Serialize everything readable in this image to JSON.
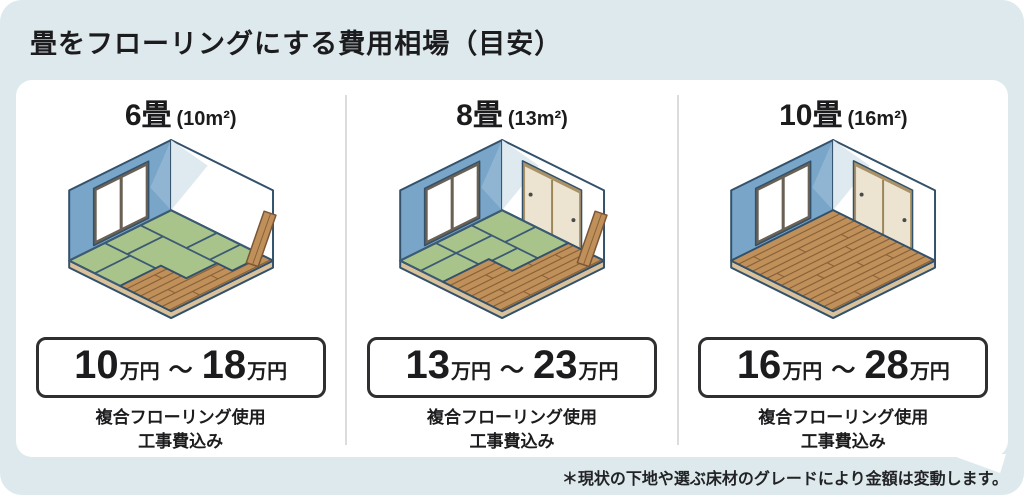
{
  "title": "畳をフローリングにする費用相場（目安）",
  "footnote": "＊現状の下地や選ぶ床材のグレードにより金額は変動します。",
  "panels": [
    {
      "size": "6畳",
      "area": "(10m²)",
      "price_min": "10",
      "price_max": "18",
      "price_unit": "万円",
      "tilde": "～",
      "note_line1": "複合フローリング使用",
      "note_line2": "工事費込み",
      "room": {
        "tatami": true,
        "doors": false,
        "plank": true,
        "wood_polygon": [
          [
            0.5,
            1
          ],
          [
            0.5,
            0.6
          ],
          [
            0.75,
            0.6
          ],
          [
            0.75,
            0.3
          ],
          [
            0.9,
            0.3
          ],
          [
            0.9,
            0
          ],
          [
            1,
            0
          ],
          [
            1,
            1
          ]
        ],
        "tatami_polygon": [
          [
            0,
            0
          ],
          [
            0.9,
            0
          ],
          [
            0.9,
            0.3
          ],
          [
            0.75,
            0.3
          ],
          [
            0.75,
            0.6
          ],
          [
            0.5,
            0.6
          ],
          [
            0.5,
            1
          ],
          [
            0,
            1
          ]
        ],
        "tatami_seams": [
          [
            [
              0,
              0.3
            ],
            [
              0.9,
              0.3
            ]
          ],
          [
            [
              0,
              0.65
            ],
            [
              0.5,
              0.65
            ]
          ],
          [
            [
              0.45,
              0
            ],
            [
              0.45,
              0.3
            ]
          ],
          [
            [
              0.68,
              0
            ],
            [
              0.68,
              0.3
            ]
          ],
          [
            [
              0.22,
              0.3
            ],
            [
              0.22,
              0.65
            ]
          ],
          [
            [
              0.25,
              0.65
            ],
            [
              0.25,
              1
            ]
          ]
        ]
      }
    },
    {
      "size": "8畳",
      "area": "(13m²)",
      "price_min": "13",
      "price_max": "23",
      "price_unit": "万円",
      "tilde": "～",
      "note_line1": "複合フローリング使用",
      "note_line2": "工事費込み",
      "room": {
        "tatami": true,
        "doors": true,
        "plank": true,
        "wood_polygon": [
          [
            0.42,
            1
          ],
          [
            0.42,
            0.55
          ],
          [
            0.65,
            0.55
          ],
          [
            0.65,
            0
          ],
          [
            1,
            0
          ],
          [
            1,
            1
          ]
        ],
        "tatami_polygon": [
          [
            0,
            0
          ],
          [
            0.65,
            0
          ],
          [
            0.65,
            0.55
          ],
          [
            0.42,
            0.55
          ],
          [
            0.42,
            1
          ],
          [
            0,
            1
          ]
        ],
        "tatami_seams": [
          [
            [
              0,
              0.3
            ],
            [
              0.65,
              0.3
            ]
          ],
          [
            [
              0,
              0.65
            ],
            [
              0.42,
              0.65
            ]
          ],
          [
            [
              0.33,
              0
            ],
            [
              0.33,
              0.3
            ]
          ],
          [
            [
              0.45,
              0.3
            ],
            [
              0.45,
              0.55
            ]
          ],
          [
            [
              0.2,
              0.3
            ],
            [
              0.2,
              0.65
            ]
          ],
          [
            [
              0.2,
              0.65
            ],
            [
              0.2,
              1
            ]
          ]
        ]
      }
    },
    {
      "size": "10畳",
      "area": "(16m²)",
      "price_min": "16",
      "price_max": "28",
      "price_unit": "万円",
      "tilde": "～",
      "note_line1": "複合フローリング使用",
      "note_line2": "工事費込み",
      "room": {
        "tatami": false,
        "doors": true,
        "plank": false,
        "wood_polygon": [
          [
            0,
            0
          ],
          [
            1,
            0
          ],
          [
            1,
            1
          ],
          [
            0,
            1
          ]
        ],
        "tatami_polygon": null,
        "tatami_seams": []
      }
    }
  ],
  "colors": {
    "background": "#dde9ec",
    "card": "#ffffff",
    "divider": "#dcdcdc",
    "text": "#1c1c1e",
    "price_border": "#2f2f31",
    "outline": "#33516b",
    "wall_blue": "#78a5c8",
    "wall_white": "#ffffff",
    "wall_shade": "#dfeaf0",
    "tatami": "#a8c48b",
    "tatami_seam": "#3c5a74",
    "wood": "#c0905a",
    "wood_line": "#8a6137",
    "slab": "#d9c29b",
    "window_frame": "#6a6154",
    "door_frame": "#ab9266",
    "door_fill": "#ece4d1",
    "door_divider": "#9b8658",
    "handle": "#4a4a4a",
    "plank_outline": "#7a5636"
  }
}
